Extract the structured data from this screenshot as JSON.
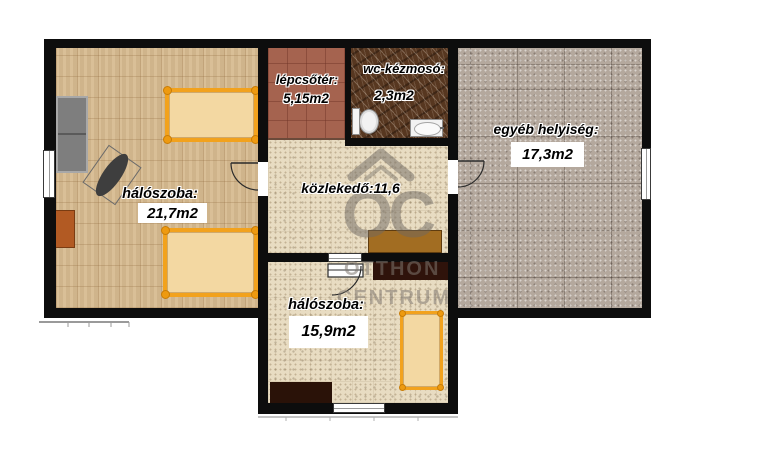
{
  "plan_title": "emeleti alaprajz",
  "rooms": {
    "bedroom_left": {
      "name": "hálószoba:",
      "area": "21,7m2"
    },
    "stairwell": {
      "name": "lépcsőtér:",
      "area": "5,15m2"
    },
    "wc": {
      "name": "wc-kézmosó:",
      "area": "2,3m2"
    },
    "other_room": {
      "name": "egyéb helyiség:",
      "area": "17,3m2"
    },
    "hallway": {
      "name": "közlekedő:11,6"
    },
    "bedroom_bottom": {
      "name": "hálószoba:",
      "area": "15,9m2"
    }
  },
  "watermark": {
    "monogram": "OC",
    "line1": "OTTHON",
    "line2": "CENTRUM"
  },
  "colors": {
    "wall": "#0d0d0d",
    "wood_floor": "#d6ba8f",
    "stair_tile": "#a5634f",
    "wc_marble": "#573720",
    "speckle_floor": "#e8dcc2",
    "gray_tile": "#b4a89d",
    "bed_frame": "#f2a21d",
    "bed_fill": "#f3d8a2",
    "sofa_gray": "#7e7e7e",
    "hall_cabinet": "#a26d22",
    "dark_furniture": "#2f130b",
    "dresser": "#b25a23"
  }
}
